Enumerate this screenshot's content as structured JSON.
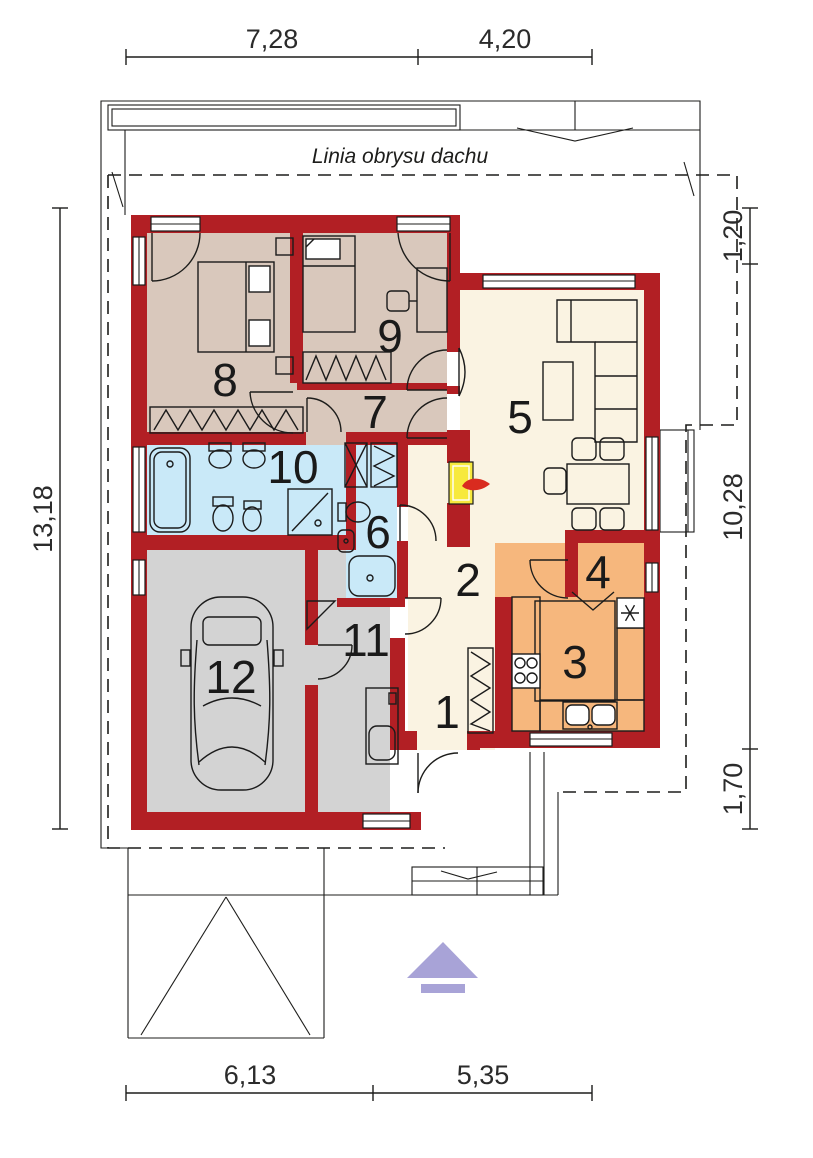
{
  "roof_label": "Linia obrysu dachu",
  "dims": {
    "top": [
      "7,28",
      "4,20"
    ],
    "bottom": [
      "6,13",
      "5,35"
    ],
    "left": [
      "13,18"
    ],
    "right": [
      "1,20",
      "10,28",
      "1,70"
    ]
  },
  "rooms": [
    {
      "number": "1"
    },
    {
      "number": "2"
    },
    {
      "number": "3"
    },
    {
      "number": "4"
    },
    {
      "number": "5"
    },
    {
      "number": "6"
    },
    {
      "number": "7"
    },
    {
      "number": "8"
    },
    {
      "number": "9"
    },
    {
      "number": "10"
    },
    {
      "number": "11"
    },
    {
      "number": "12"
    }
  ],
  "colors": {
    "wall": "#b21f24",
    "bedroom": "#d9c8bc",
    "living": "#faf3e2",
    "bath": "#c9e9f8",
    "garage": "#d3d3d3",
    "kitchen": "#f6b77d",
    "kitchen_light": "#f9cfa0",
    "counter": "#f4b072",
    "fireplace": "#f7e93d",
    "flame": "#d92b1f",
    "arrow": "#a8a3d7",
    "line": "#1d1d1b"
  }
}
